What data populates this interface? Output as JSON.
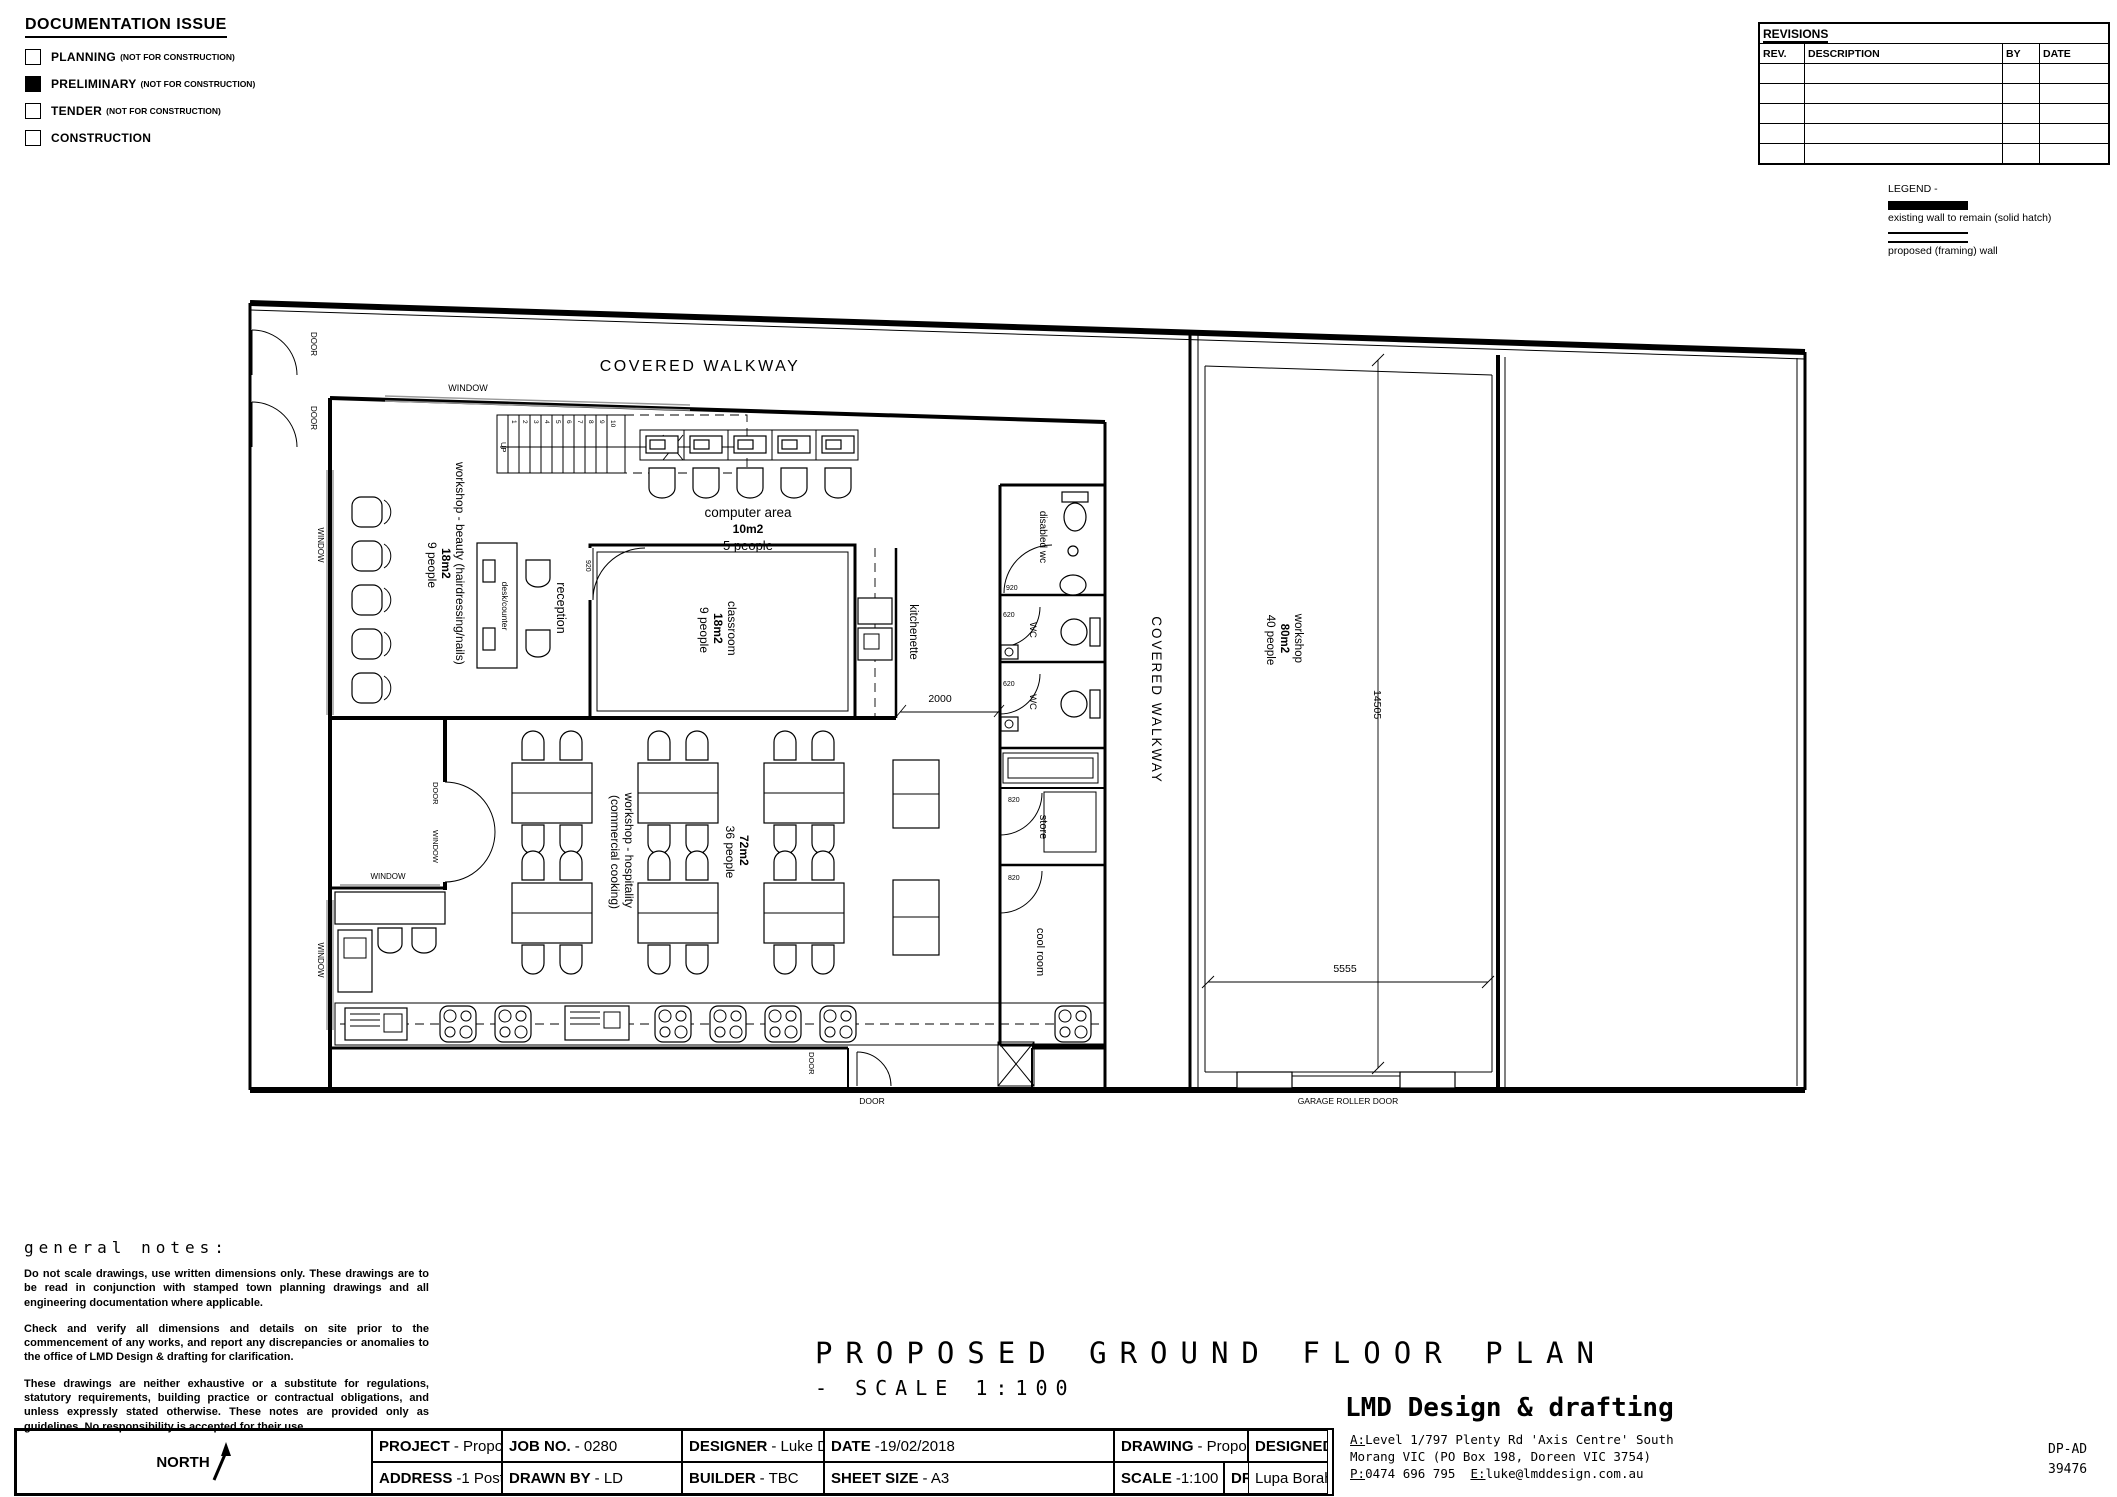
{
  "doc_issue": {
    "title": "DOCUMENTATION ISSUE",
    "items": [
      {
        "label": "PLANNING",
        "note": "(NOT FOR CONSTRUCTION)",
        "checked": false
      },
      {
        "label": "PRELIMINARY",
        "note": "(NOT FOR CONSTRUCTION)",
        "checked": true
      },
      {
        "label": "TENDER",
        "note": "(NOT FOR CONSTRUCTION)",
        "checked": false
      },
      {
        "label": "CONSTRUCTION",
        "note": "",
        "checked": false
      }
    ]
  },
  "revisions": {
    "title": "REVISIONS",
    "columns": {
      "rev": "REV.",
      "description": "DESCRIPTION",
      "by": "BY",
      "date": "DATE"
    }
  },
  "legend": {
    "title": "LEGEND -",
    "existing": "existing wall to remain (solid hatch)",
    "proposed": "proposed (framing) wall"
  },
  "plan": {
    "covered_walkway": "COVERED WALKWAY",
    "window": "WINDOW",
    "door": "DOOR",
    "up": "UP",
    "garage_door": "GARAGE ROLLER DOOR",
    "stairs": [
      "1",
      "2",
      "3",
      "4",
      "5",
      "6",
      "7",
      "8",
      "9",
      "10"
    ],
    "computer_area": {
      "l1": "computer area",
      "l2": "10m2",
      "l3": "5 people"
    },
    "beauty": {
      "l1": "workshop - beauty (hairdressing/nails)",
      "l2": "18m2",
      "l3": "9 people"
    },
    "desk": "desk/counter",
    "reception": "reception",
    "classroom": {
      "l1": "classroom",
      "l2": "18m2",
      "l3": "9 people"
    },
    "kitchenette": "kitchenette",
    "disabled_wc": "disabled wc",
    "wc": "WC",
    "store": "store",
    "cool_room": "cool room",
    "hospitality": {
      "l1": "workshop - hospitality",
      "l2": "(commercial cooking)",
      "l3": "72m2",
      "l4": "36 people"
    },
    "workshop": {
      "l1": "workshop",
      "l2": "80m2",
      "l3": "40 people"
    },
    "dims": {
      "opening": "2000",
      "length": "14505",
      "width": "5555"
    },
    "door_sizes": {
      "d920": "920",
      "d820": "820",
      "d620": "620"
    }
  },
  "notes": {
    "title": "general notes:",
    "p1": "Do not scale drawings, use written dimensions only. These drawings are to be read in conjunction with stamped town planning drawings and all engineering documentation where applicable.",
    "p2": "Check and verify all dimensions and details on site prior to the commencement of any works, and report any discrepancies or anomalies to the office of LMD Design & drafting for clarification.",
    "p3": "These drawings are neither exhaustive or a substitute for regulations, statutory requirements, building practice or contractual obligations, and unless expressly stated otherwise. These notes are provided only as guidelines. No responsibility is accepted for their use."
  },
  "drawing_title": {
    "main": "PROPOSED GROUND FLOOR PLAN",
    "scale": "- SCALE 1:100"
  },
  "titleblock": {
    "project_label": "PROJECT",
    "project": "- Proposed Educational Facility",
    "address_label": "ADDRESS",
    "address": "-1 Post Office Place, Glenroy VIC",
    "job_label": "JOB NO.",
    "job": "- 0280",
    "drawn_label": "DRAWN BY",
    "drawn": "- LD",
    "designer_label": "DESIGNER",
    "designer": "- Luke Drakes",
    "builder_label": "BUILDER",
    "builder": "- TBC",
    "date_label": "DATE",
    "date": "-19/02/2018",
    "sheet_label": "SHEET SIZE",
    "sheet": "- A3",
    "drawing_label": "DRAWING",
    "drawing": "-  Proposed Ground Floor Plan",
    "scale_label": "SCALE",
    "scale": "-1:100",
    "number_label": "DRAWING NO.",
    "number": "- SK01",
    "designed_label": "DESIGNED FOR -",
    "designed": "Lupa Borah",
    "north": "NORTH"
  },
  "firm": {
    "name": "LMD Design & drafting",
    "addr1": "Level 1/797 Plenty Rd 'Axis Centre' South",
    "addr2": "Morang VIC (PO Box 198, Doreen VIC 3754)",
    "addr3a": "0474 696 795",
    "addr3b": "luke@lmddesign.com.au",
    "reg1": "DP-AD",
    "reg2": "39476"
  }
}
